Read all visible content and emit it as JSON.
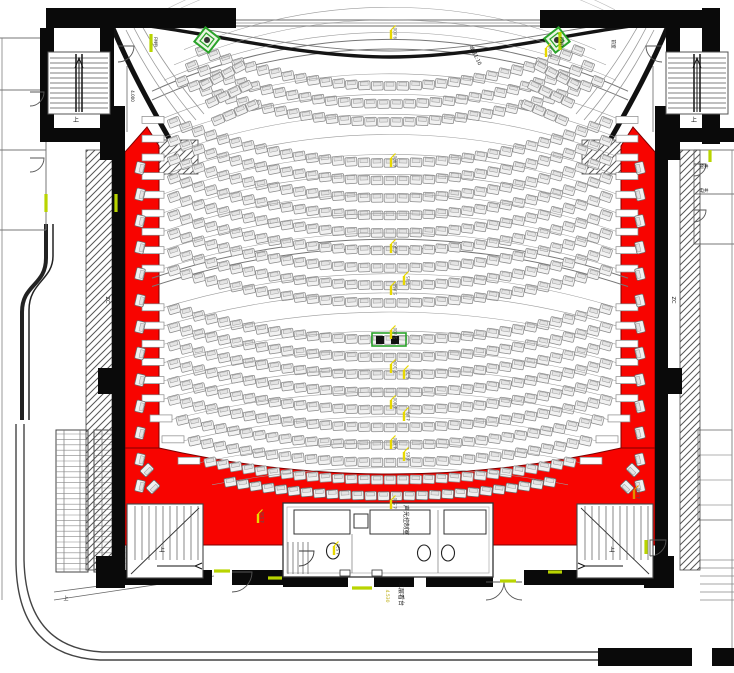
{
  "drawing": {
    "kind": "theatre-balcony-seating-plan",
    "background": "#ffffff"
  },
  "colors": {
    "aisle_red": "#f80400",
    "aisle_red_edge": "#7e0000",
    "wall_black": "#0a0a0a",
    "seat_fill": "#f1f1f1",
    "seat_stroke": "#8a8a8a",
    "seat_inner": "#e3e3e3",
    "door_marker_lime": "#b9d400",
    "elevation_yellow": "#e8d800",
    "speaker_green": "#2aa32a",
    "hatch_gray": "#555555",
    "line_gray": "#888888"
  },
  "seating": {
    "arc_center": {
      "x": 390,
      "y": -430
    },
    "seat_pitch": 13,
    "blocks": [
      {
        "id": "balcony-front",
        "rows": [
          {
            "y": 86,
            "half": 194
          },
          {
            "y": 104,
            "half": 204
          },
          {
            "y": 122,
            "half": 214
          }
        ]
      },
      {
        "id": "main-upper",
        "rows": [
          {
            "y": 163,
            "half": 222
          },
          {
            "y": 180.5,
            "half": 222
          },
          {
            "y": 198,
            "half": 222
          },
          {
            "y": 215.5,
            "half": 222
          },
          {
            "y": 233,
            "half": 222
          },
          {
            "y": 250.5,
            "half": 222
          },
          {
            "y": 268,
            "half": 222
          },
          {
            "y": 285.5,
            "half": 222
          },
          {
            "y": 303,
            "half": 222
          }
        ]
      },
      {
        "id": "main-lower",
        "rows": [
          {
            "y": 340,
            "half": 222
          },
          {
            "y": 357.5,
            "half": 222
          },
          {
            "y": 375,
            "half": 222
          },
          {
            "y": 392.5,
            "half": 222
          },
          {
            "y": 410,
            "half": 222
          },
          {
            "y": 427.5,
            "half": 222
          },
          {
            "y": 445,
            "half": 214
          },
          {
            "y": 462.5,
            "half": 202
          },
          {
            "y": 480,
            "half": 186
          }
        ]
      },
      {
        "id": "rear-row-on-red",
        "rows": [
          {
            "y": 496,
            "half": 166
          }
        ]
      }
    ],
    "wing_rows_left": [
      {
        "x": 206,
        "y": 84,
        "angle": -27,
        "seats": 4
      },
      {
        "x": 212,
        "y": 102,
        "angle": -25,
        "seats": 4
      },
      {
        "x": 218,
        "y": 120,
        "angle": -23,
        "seats": 4
      }
    ],
    "side_seats": {
      "left_x": 140,
      "right_x": 640,
      "y_start": 168,
      "y_step": 26.5,
      "count": 13,
      "tilt": 103
    },
    "corner_seats": [
      {
        "x": 147,
        "y": 470,
        "rot": 135
      },
      {
        "x": 153,
        "y": 487,
        "rot": 135
      },
      {
        "x": 633,
        "y": 470,
        "rot": -135
      },
      {
        "x": 627,
        "y": 487,
        "rot": -135
      }
    ]
  },
  "labels": [
    {
      "text": "ZC",
      "x": 106,
      "y": 300,
      "rot": 90,
      "size": 5,
      "color": "#111111"
    },
    {
      "text": "ZC",
      "x": 672,
      "y": 300,
      "rot": 90,
      "size": 5,
      "color": "#111111"
    },
    {
      "text": "声光控制室",
      "x": 404,
      "y": 520,
      "rot": 90,
      "size": 6,
      "color": "#111111"
    },
    {
      "text": "二层看台",
      "x": 399,
      "y": 594,
      "rot": 90,
      "size": 6,
      "color": "#111111"
    },
    {
      "text": "4.530",
      "x": 386,
      "y": 596,
      "rot": 90,
      "size": 4.5,
      "color": "#b8a800"
    },
    {
      "text": "坡道1:10",
      "x": 474,
      "y": 56,
      "rot": 64,
      "size": 5,
      "color": "#111111"
    },
    {
      "text": "管井",
      "x": 704,
      "y": 168,
      "rot": 0,
      "size": 4.5,
      "color": "#111111"
    },
    {
      "text": "电井",
      "x": 704,
      "y": 192,
      "rot": 0,
      "size": 4.5,
      "color": "#111111"
    },
    {
      "text": "上",
      "x": 76,
      "y": 122,
      "rot": 0,
      "size": 6,
      "color": "#111111"
    },
    {
      "text": "上",
      "x": 694,
      "y": 122,
      "rot": 0,
      "size": 6,
      "color": "#111111"
    },
    {
      "text": "上",
      "x": 162,
      "y": 552,
      "rot": 0,
      "size": 6,
      "color": "#111111"
    },
    {
      "text": "上",
      "x": 612,
      "y": 552,
      "rot": 0,
      "size": 6,
      "color": "#111111"
    },
    {
      "text": "上",
      "x": 66,
      "y": 600,
      "rot": 0,
      "size": 5,
      "color": "#111111"
    },
    {
      "text": "FM甲",
      "x": 154,
      "y": 42,
      "rot": 90,
      "size": 4,
      "color": "#111111"
    },
    {
      "text": "FM甲",
      "x": 560,
      "y": 42,
      "rot": 90,
      "size": 4,
      "color": "#111111"
    },
    {
      "text": "4.000",
      "x": 131,
      "y": 96,
      "rot": 90,
      "size": 4,
      "color": "#111111"
    },
    {
      "text": "前室",
      "x": 612,
      "y": 44,
      "rot": 90,
      "size": 4.5,
      "color": "#111111"
    }
  ],
  "elevation_markers": [
    {
      "x": 391,
      "y": 30,
      "text": "9.000"
    },
    {
      "x": 391,
      "y": 158,
      "text": "6.900"
    },
    {
      "x": 391,
      "y": 244,
      "text": "6.300"
    },
    {
      "x": 391,
      "y": 286,
      "text": "5.850"
    },
    {
      "x": 404,
      "y": 276,
      "text": "5.85"
    },
    {
      "x": 391,
      "y": 330,
      "text": "5.400"
    },
    {
      "x": 391,
      "y": 364,
      "text": "5.100"
    },
    {
      "x": 404,
      "y": 370,
      "text": "5.10"
    },
    {
      "x": 391,
      "y": 400,
      "text": "4.800"
    },
    {
      "x": 404,
      "y": 412,
      "text": "4.80"
    },
    {
      "x": 391,
      "y": 440,
      "text": "4.650"
    },
    {
      "x": 404,
      "y": 452,
      "text": "4.65"
    },
    {
      "x": 391,
      "y": 500,
      "text": "4.530"
    },
    {
      "x": 334,
      "y": 546,
      "text": "4.530"
    },
    {
      "x": 258,
      "y": 514,
      "text": "4.530"
    },
    {
      "x": 634,
      "y": 490,
      "text": "4.530",
      "color": "#e09000"
    },
    {
      "x": 546,
      "y": 48,
      "text": "8.000"
    }
  ],
  "icons": [
    {
      "name": "speaker-icon",
      "x": 207,
      "y": 40,
      "rot": 38
    },
    {
      "name": "speaker-icon",
      "x": 557,
      "y": 40,
      "rot": -38
    },
    {
      "name": "camera-console-icon",
      "x": 389,
      "y": 340,
      "rot": 0
    }
  ],
  "door_markers": [
    {
      "x": 151,
      "y": 34,
      "len": 18,
      "dir": "v"
    },
    {
      "x": 560,
      "y": 32,
      "len": 18,
      "dir": "v"
    },
    {
      "x": 116,
      "y": 194,
      "len": 18,
      "dir": "v"
    },
    {
      "x": 46,
      "y": 194,
      "len": 18,
      "dir": "v"
    },
    {
      "x": 214,
      "y": 571,
      "len": 16,
      "dir": "h"
    },
    {
      "x": 268,
      "y": 578,
      "len": 14,
      "dir": "h"
    },
    {
      "x": 352,
      "y": 588,
      "len": 20,
      "dir": "h"
    },
    {
      "x": 500,
      "y": 581,
      "len": 16,
      "dir": "h"
    },
    {
      "x": 548,
      "y": 572,
      "len": 14,
      "dir": "h"
    },
    {
      "x": 710,
      "y": 150,
      "len": 12,
      "dir": "v"
    },
    {
      "x": 646,
      "y": 540,
      "len": 14,
      "dir": "v"
    }
  ]
}
